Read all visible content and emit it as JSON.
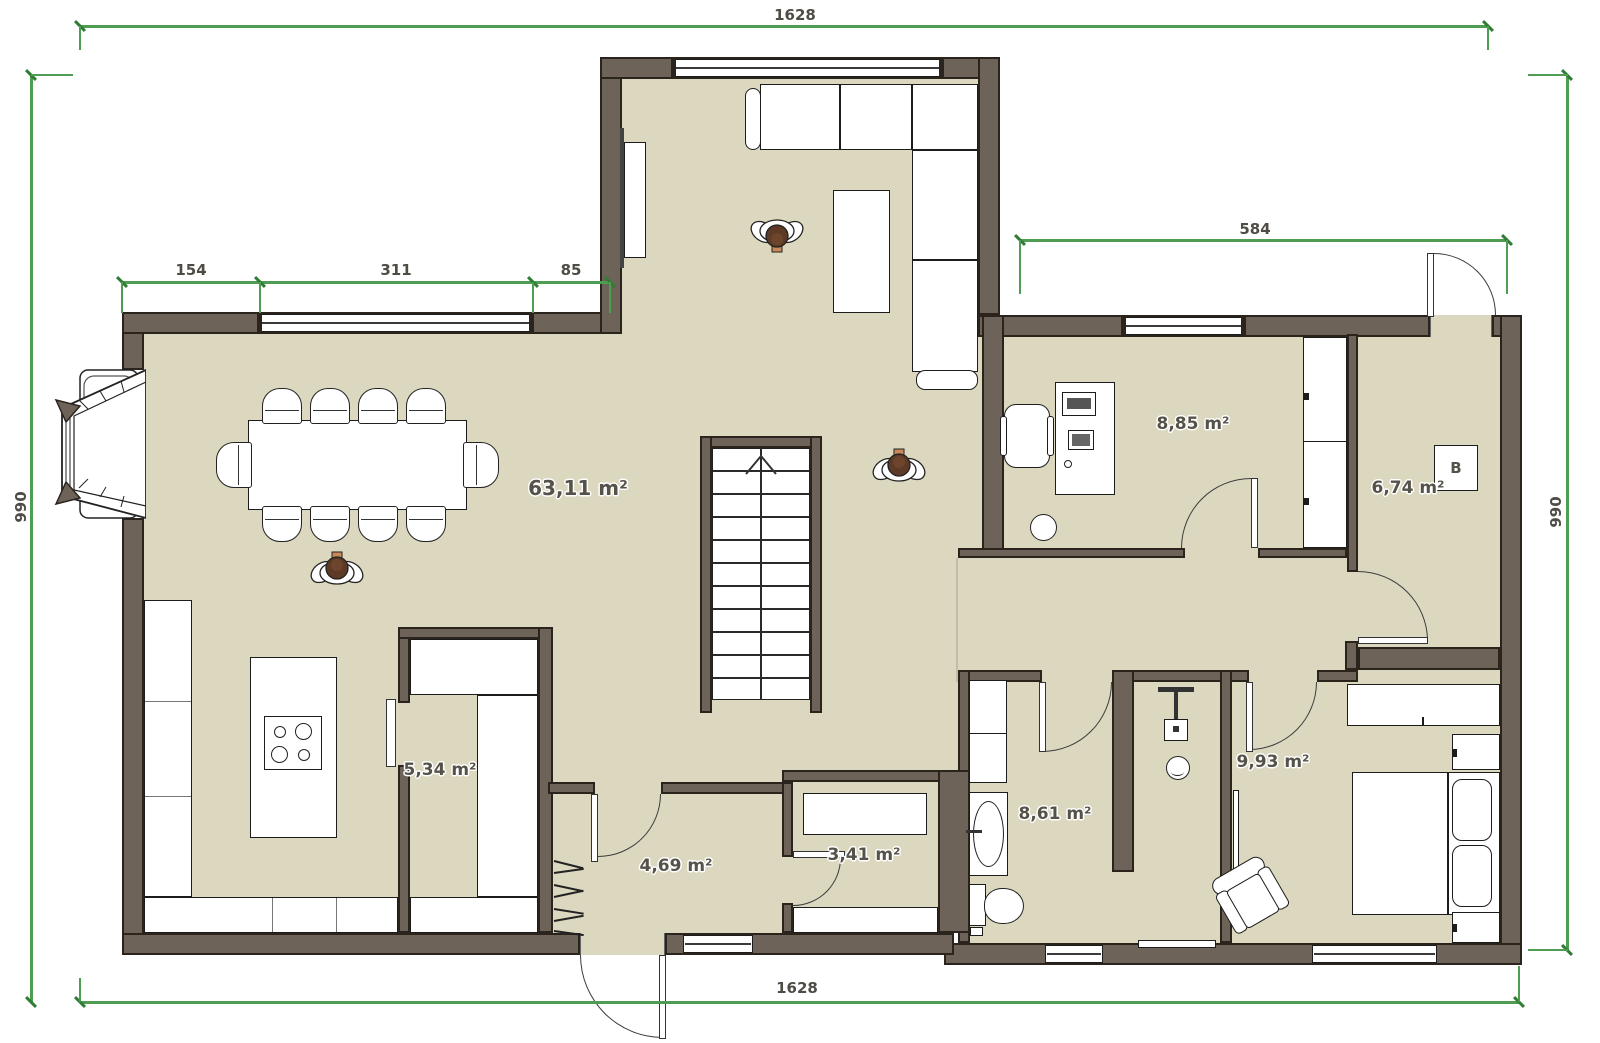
{
  "colors": {
    "wall": "#6e6359",
    "floor": "#dcd7bf",
    "outline": "#1c1c1c",
    "dimension_line": "#4f9d53",
    "person_head": "#5c3a26"
  },
  "dimensions": {
    "top": "1628",
    "bottom": "1628",
    "left": "990",
    "right": "990",
    "seg1": "154",
    "seg2": "311",
    "seg3": "85",
    "wing": "584"
  },
  "rooms": {
    "living": {
      "name": "living-dining-kitchen",
      "area": "63,11 m²"
    },
    "office": {
      "name": "office",
      "area": "8,85 m²"
    },
    "technical": {
      "name": "technical-room",
      "area": "6,74 m²"
    },
    "pantry": {
      "name": "pantry",
      "area": "5,34 m²"
    },
    "entrance": {
      "name": "entrance-hall",
      "area": "4,69 m²"
    },
    "closet": {
      "name": "closet",
      "area": "3,41 m²"
    },
    "bathroom": {
      "name": "bathroom",
      "area": "8,61 m²"
    },
    "bedroom": {
      "name": "bedroom",
      "area": "9,93 m²"
    }
  },
  "appliances": {
    "boiler": "B"
  }
}
